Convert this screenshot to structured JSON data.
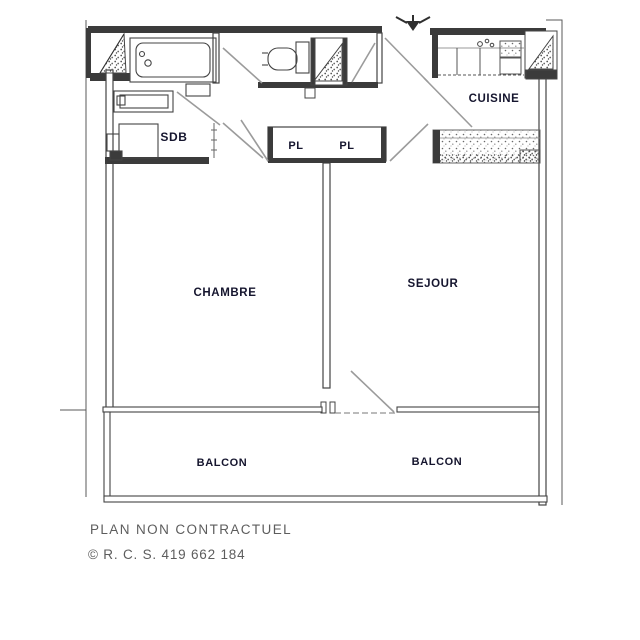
{
  "plan": {
    "rooms": {
      "sdb": "SDB",
      "cuisine": "CUISINE",
      "pl_left": "PL",
      "pl_right": "PL",
      "chambre": "CHAMBRE",
      "sejour": "SEJOUR",
      "balcon_left": "BALCON",
      "balcon_right": "BALCON"
    },
    "footer": {
      "disclaimer": "PLAN NON CONTRACTUEL",
      "registration": "© R. C. S. 419 662 184"
    },
    "icons": {
      "north_arrow": "north-arrow-icon"
    },
    "colors": {
      "wall_dark": "#3b3b3b",
      "wall_stroke": "#444444",
      "door_swing": "#9b9b9b",
      "label_text": "#15152e",
      "footer_text": "#5d5d5d",
      "background": "#ffffff"
    }
  }
}
